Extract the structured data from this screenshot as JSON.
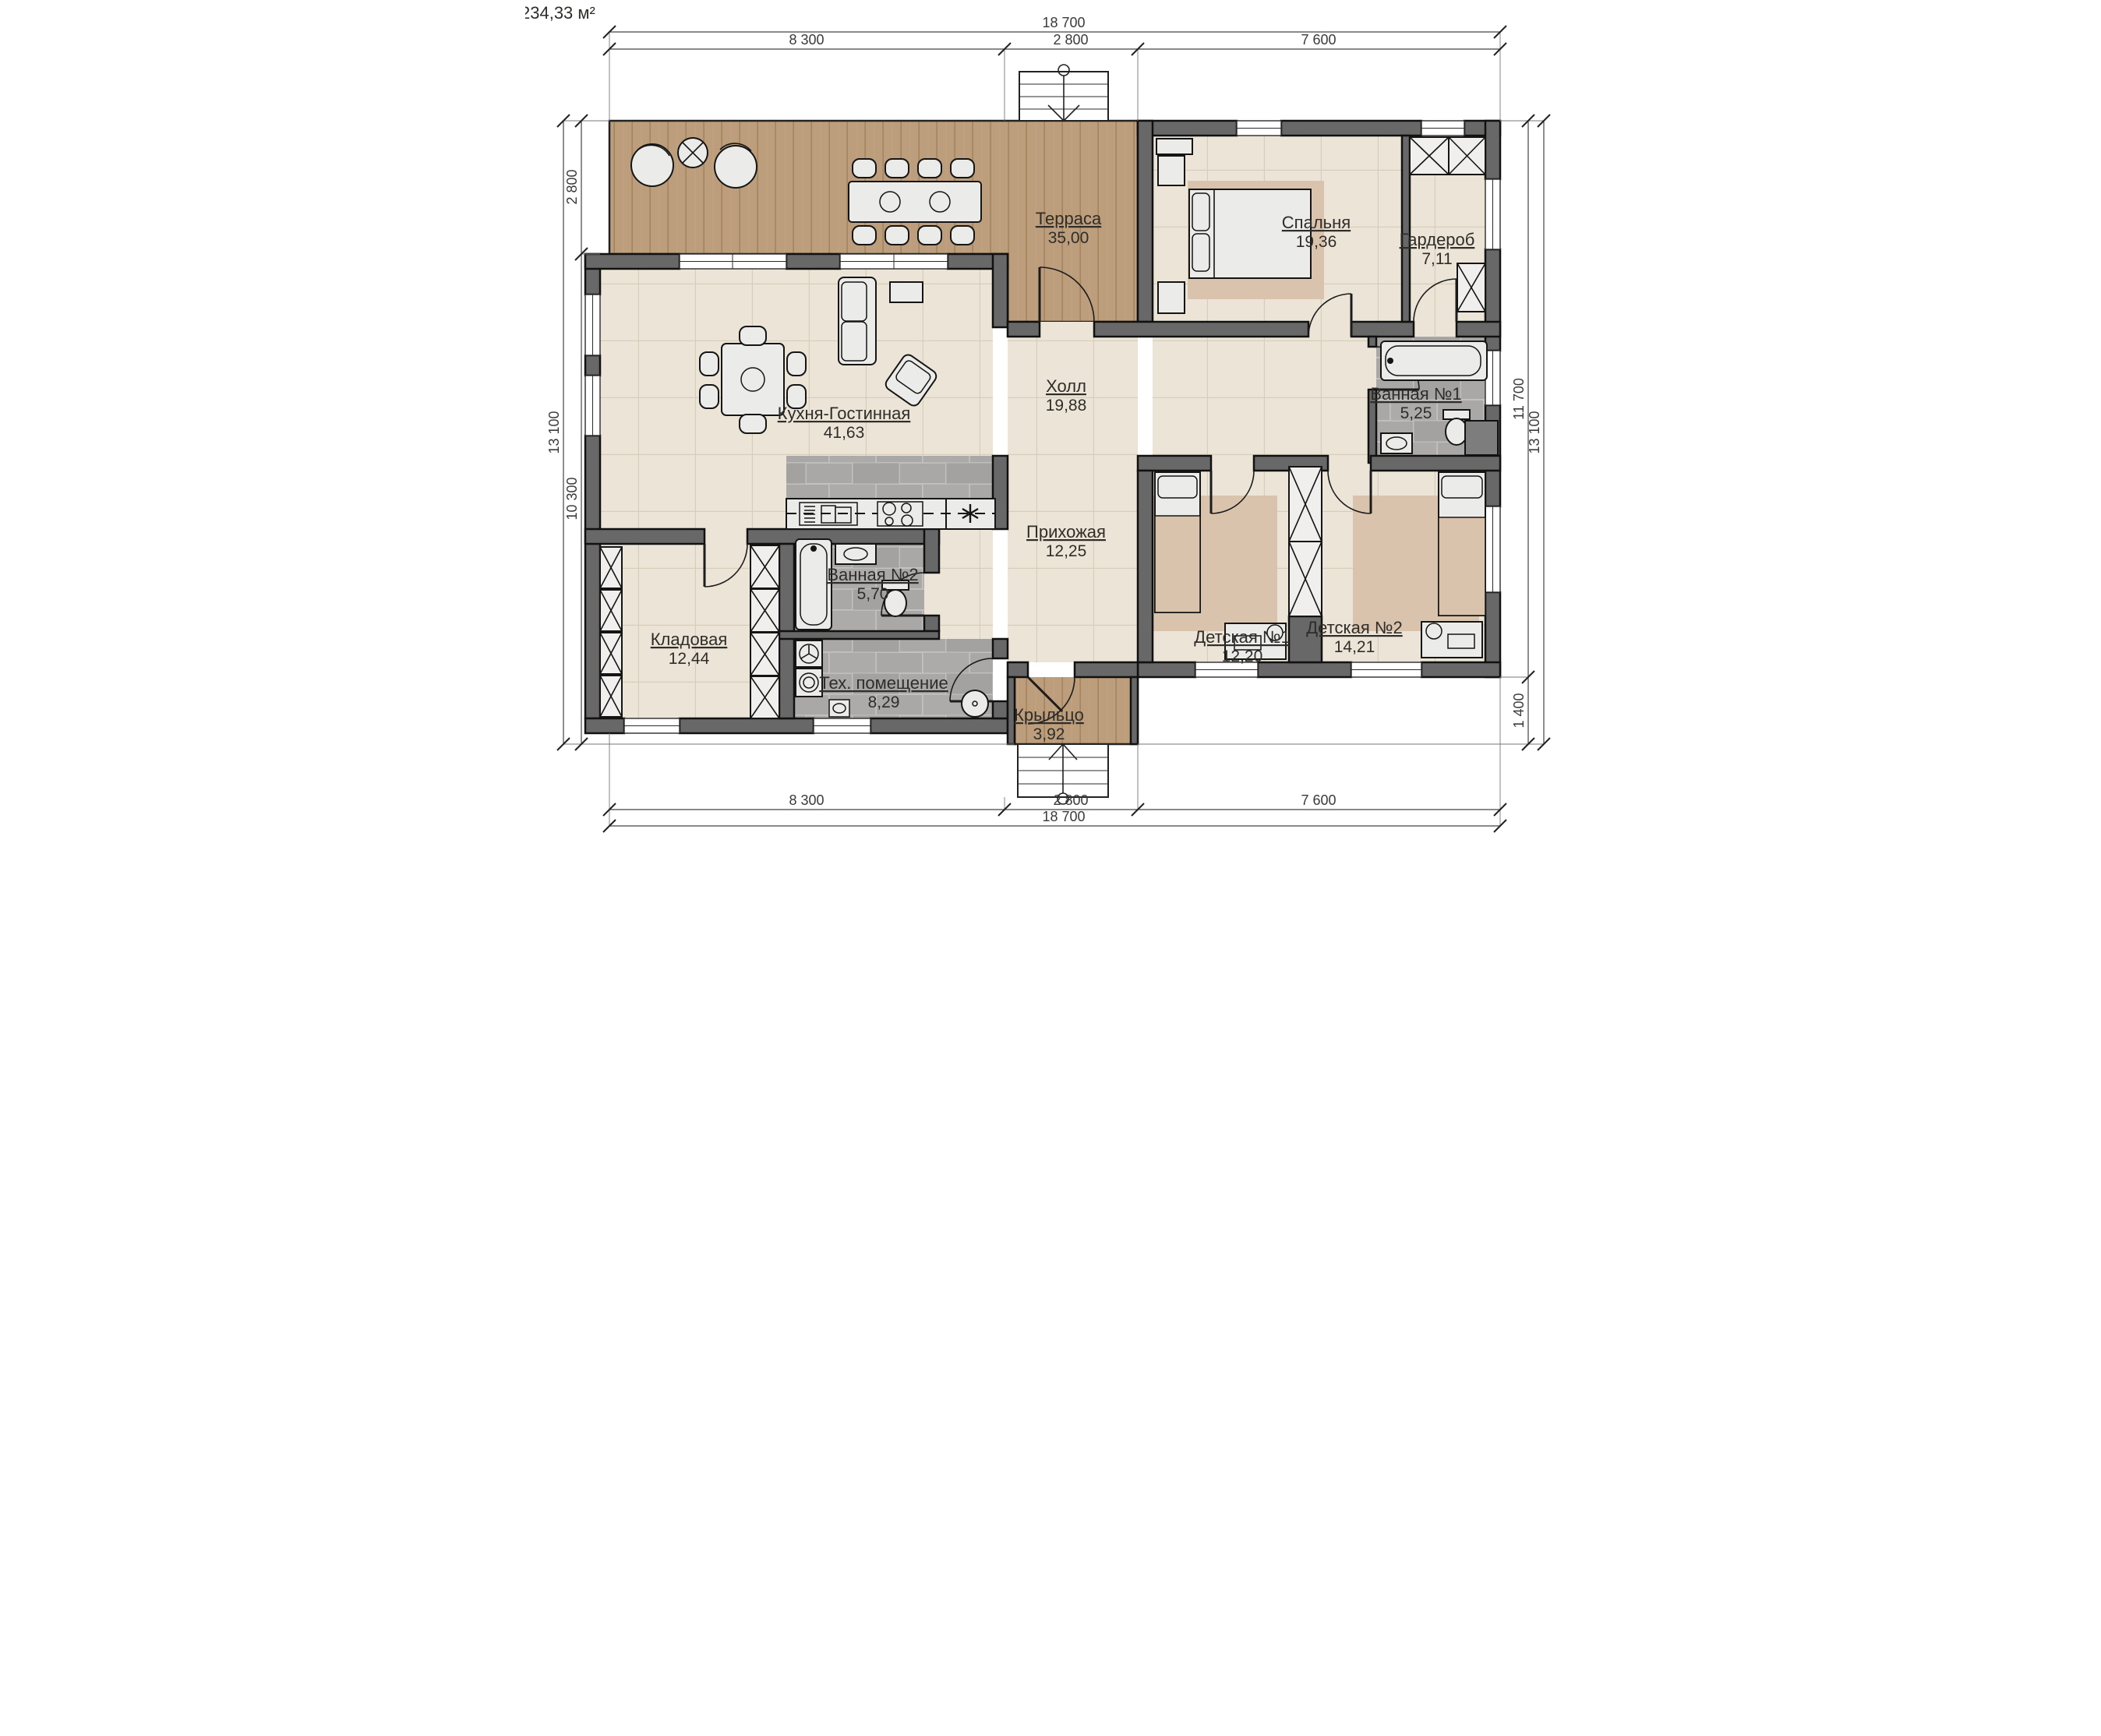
{
  "meta": {
    "total_area": "234,33 м²"
  },
  "rooms": {
    "terrace": {
      "name": "Терраса",
      "area": "35,00"
    },
    "bedroom": {
      "name": "Спальня",
      "area": "19,36"
    },
    "wardrobe": {
      "name": "Гардероб",
      "area": "7,11"
    },
    "hall": {
      "name": "Холл",
      "area": "19,88"
    },
    "kitchen_living": {
      "name": "Кухня-Гостинная",
      "area": "41,63"
    },
    "bathroom1": {
      "name": "Ванная №1",
      "area": "5,25"
    },
    "hallway": {
      "name": "Прихожая",
      "area": "12,25"
    },
    "bathroom2": {
      "name": "Ванная №2",
      "area": "5,70"
    },
    "storage": {
      "name": "Кладовая",
      "area": "12,44"
    },
    "tech": {
      "name": "Тех. помещение",
      "area": "8,29"
    },
    "kids1": {
      "name": "Детская №1",
      "area": "12,20"
    },
    "kids2": {
      "name": "Детская №2",
      "area": "14,21"
    },
    "porch": {
      "name": "Крыльцо",
      "area": "3,92"
    }
  },
  "dimensions": {
    "top_total": "18 700",
    "top_left": "8 300",
    "top_mid": "2 800",
    "top_right": "7 600",
    "bottom_total": "18 700",
    "bottom_left": "8 300",
    "bottom_mid": "2 800",
    "bottom_right": "7 600",
    "left_total": "13 100",
    "left_upper": "2 800",
    "left_lower": "10 300",
    "right_total": "13 100",
    "right_upper": "11 700",
    "right_lower": "1 400"
  },
  "colors": {
    "wall": "#686868",
    "wood": "#bc9d7c",
    "wood_line": "#a5855f",
    "tile_beige": "#ece5d7",
    "tile_beige_line": "#d8cdbb",
    "tile_gray": "#a9a8a6",
    "tile_gray_line": "#c6c5c3",
    "rug": "#d9c3ad"
  }
}
